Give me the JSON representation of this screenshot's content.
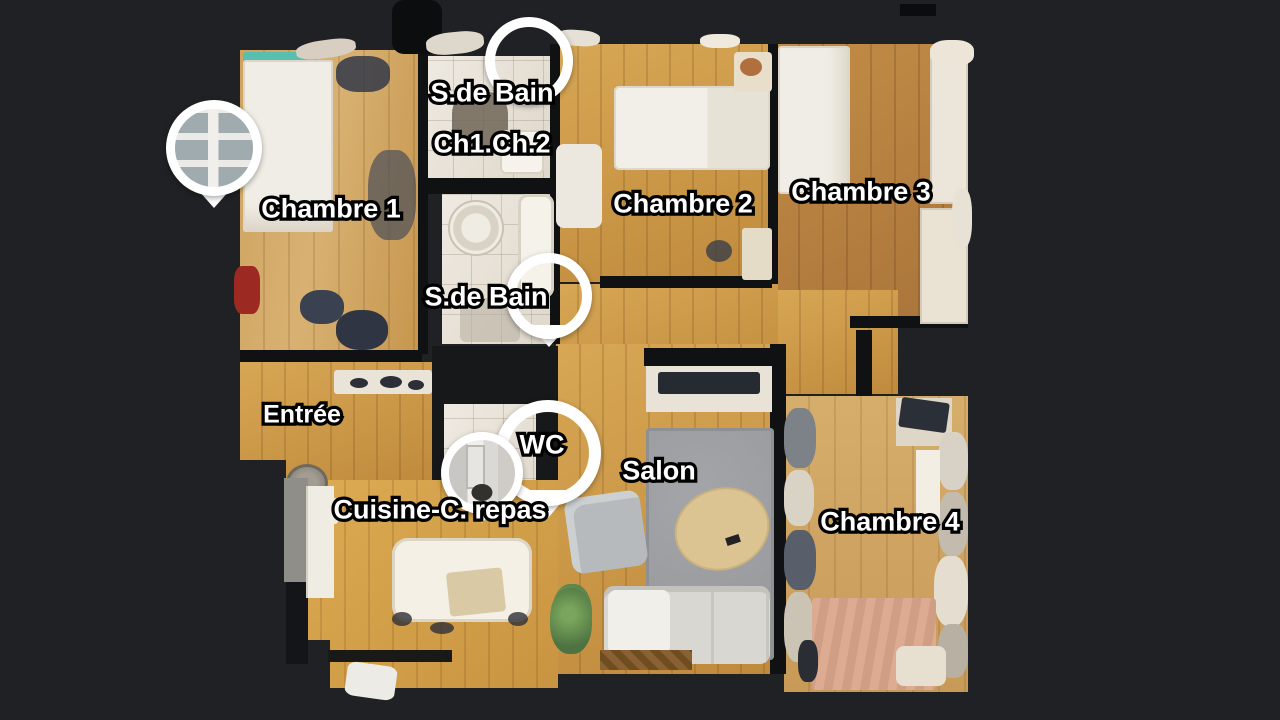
{
  "app": {
    "name": "virtual-tour-floor-plan",
    "view": "top-down floor plan (dollhouse) of an apartment"
  },
  "colors": {
    "background": "#202124",
    "wall": "#101113",
    "wood_light": "#d4a965",
    "wood_gold": "#cf9a4a",
    "wood_red_brown": "#b9813e",
    "wood_pale": "#cfa767",
    "bathroom_tile": "#ebe6dd",
    "rug_gray": "#9b9da0",
    "bed_white": "#f0ede6",
    "bed_tan": "#d7a68e",
    "teal_blanket": "#58bfae",
    "marker_white": "#ffffff",
    "label_text": "#ffffff",
    "label_outline": "#000000"
  },
  "labels": [
    {
      "id": "sdb-top",
      "text": "S.de Bain",
      "x": 492,
      "y": 93,
      "size": 27
    },
    {
      "id": "ch1-ch2",
      "text": "Ch1.Ch.2",
      "x": 492,
      "y": 144,
      "size": 27
    },
    {
      "id": "chambre-1",
      "text": "Chambre 1",
      "x": 331,
      "y": 209,
      "size": 27
    },
    {
      "id": "chambre-2",
      "text": "Chambre 2",
      "x": 683,
      "y": 204,
      "size": 27
    },
    {
      "id": "chambre-3",
      "text": "Chambre 3",
      "x": 861,
      "y": 192,
      "size": 27
    },
    {
      "id": "sdb-middle",
      "text": "S.de Bain",
      "x": 486,
      "y": 297,
      "size": 27
    },
    {
      "id": "entree",
      "text": "Entrée",
      "x": 302,
      "y": 415,
      "size": 25
    },
    {
      "id": "wc",
      "text": "WC",
      "x": 542,
      "y": 445,
      "size": 27
    },
    {
      "id": "salon",
      "text": "Salon",
      "x": 659,
      "y": 471,
      "size": 27
    },
    {
      "id": "cuisine",
      "text": "Cuisine-C. repas",
      "x": 440,
      "y": 510,
      "size": 27
    },
    {
      "id": "chambre-4",
      "text": "Chambre 4",
      "x": 890,
      "y": 522,
      "size": 27
    }
  ],
  "markers": [
    {
      "id": "sdb-top-ring",
      "type": "ring",
      "photo": null,
      "x": 529,
      "y": 61,
      "r": 44,
      "border": 10,
      "tip": false
    },
    {
      "id": "wc-ring-pin",
      "type": "ring",
      "photo": null,
      "x": 548,
      "y": 453,
      "r": 53,
      "border": 12,
      "tip": true
    },
    {
      "id": "wc-photo-pin",
      "type": "photo-pin",
      "photo": "bathroom",
      "x": 482,
      "y": 473,
      "r": 41,
      "border": 8,
      "tip": true
    },
    {
      "id": "sdb-middle-pin",
      "type": "ring",
      "photo": null,
      "x": 549,
      "y": 296,
      "r": 43,
      "border": 10,
      "tip": true
    },
    {
      "id": "entry-photo-pin",
      "type": "photo-pin",
      "photo": "window",
      "x": 214,
      "y": 148,
      "r": 48,
      "border": 9,
      "tip": true
    }
  ]
}
